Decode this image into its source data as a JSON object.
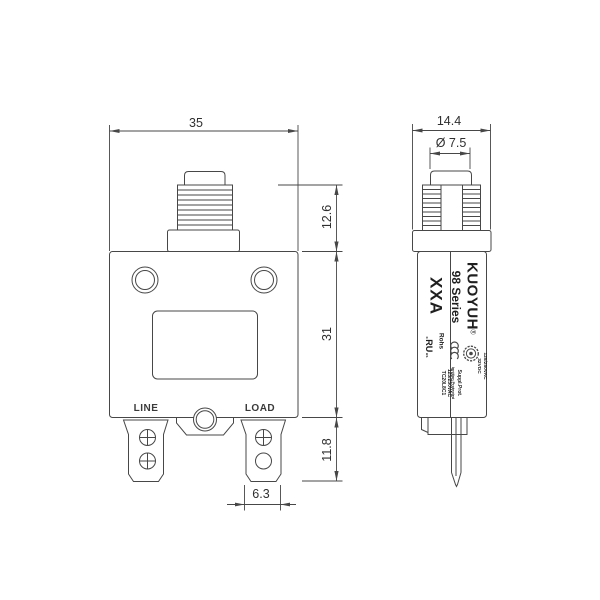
{
  "front": {
    "dim_width": "35",
    "dim_button_height": "12.6",
    "dim_body_height": "31",
    "dim_terminal_height": "11.8",
    "dim_terminal_width": "6.3",
    "line_label": "LINE",
    "load_label": "LOAD"
  },
  "side": {
    "dim_width": "14.4",
    "dim_button_diameter": "Ø 7.5",
    "brand": "KUOYUH",
    "registered": "®",
    "series": "98 Series",
    "amp_rating": "XXA",
    "rohs": "Rohs",
    "ul_prefix": "c",
    "ul_mark": "RU",
    "ul_suffix": "us",
    "voltage_line1": "125/250VAC",
    "voltage_line2": "32VDC",
    "print_line1": "Suppl.Prot.",
    "print_line2": "Ignition Protected",
    "print_line3": "125/250VAC",
    "print_line4": "TC20L8C1"
  },
  "colors": {
    "line": "#474747",
    "text": "#2e2e2e",
    "background": "#ffffff"
  }
}
